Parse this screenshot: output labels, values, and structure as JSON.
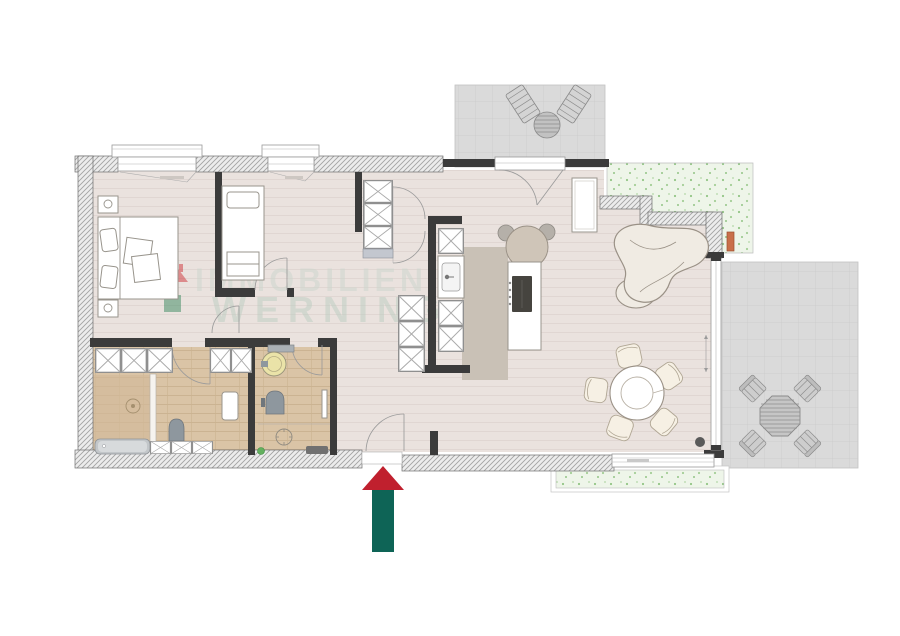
{
  "watermark": {
    "line1": "IMMOBILIEN",
    "line2": "WERNING",
    "logo_roof_color": "#d0343b",
    "logo_square_color": "#3a8a5f",
    "text_color": "#c9d4cc"
  },
  "entrance_arrow": {
    "head_color": "#c0202e",
    "shaft_color": "#0e6456",
    "points_to": "entrance-door"
  },
  "palette": {
    "interior_wall": "#3b3b3b",
    "exterior_wall_fill": "#ececec",
    "exterior_wall_hatch": "#a3a3a3",
    "floor": "#eae2de",
    "bathroom_wood_floor": "#dac4a6",
    "kitchen_floor": "#c9c1b6",
    "terrace_tile": "#dadada",
    "garden_green": "#eef5e9",
    "sofa": "#f0ebe3",
    "dining_chair": "#f6f0e4",
    "cooktop": "#46443f",
    "washbasin": "#eae3a8",
    "planter_orange": "#c96f4a",
    "fixture_gray": "#8e979e"
  },
  "inventory": {
    "bedrooms": 2,
    "bathrooms": 2,
    "double_beds": 1,
    "single_beds": 1,
    "dining_chairs": 5,
    "kitchen_islands": 1,
    "sofas": 1,
    "terraces": 2,
    "sun_loungers": 2,
    "patio_chairs": 4,
    "wardrobe_units": 5
  }
}
